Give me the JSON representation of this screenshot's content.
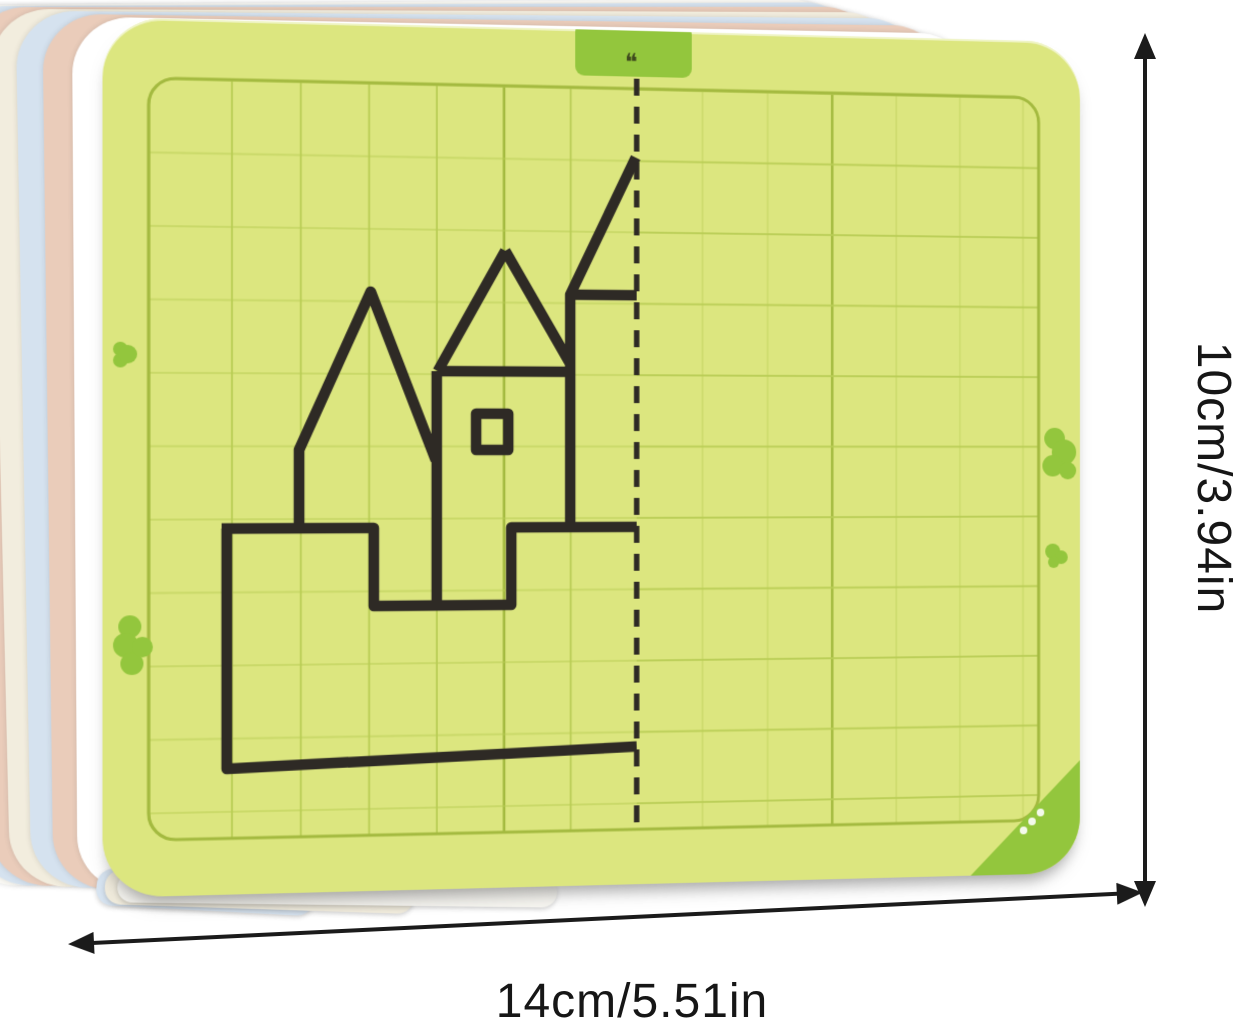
{
  "dimension_labels": {
    "width": "14cm/5.51in",
    "height": "10cm/3.94in"
  },
  "card": {
    "tab_glyph": "❝",
    "grid_rows": 10,
    "grid_cols": 13,
    "mirror_axis_x": 524,
    "castle_drawing": {
      "outline_path": "M114,497 H262 V574 H398 V497 H524 M119,497 V732 L524,717 M189,497 V420 L259,264 L323,430 M392,222 L325,342 M392,222 L457,334 M325,342 H457 M324,342 V574 M457,265 V497 M523,127 L457,265 H524",
      "window_path": "M363,384 h32 v36 h-32 Z"
    }
  },
  "colors": {
    "card_bg": "#dce67f",
    "grid_line": "#b9cd55",
    "grid_seam": "#a4ba40",
    "accent_green": "#93c63d",
    "ink": "#2e2a25",
    "annotation": "#1b1b1b"
  },
  "stack_layers": [
    "#fbfaf5",
    "#d5e2ef",
    "#eaccba",
    "#f2edde",
    "#d5e2ef",
    "#eaccba",
    "#ffffff"
  ]
}
